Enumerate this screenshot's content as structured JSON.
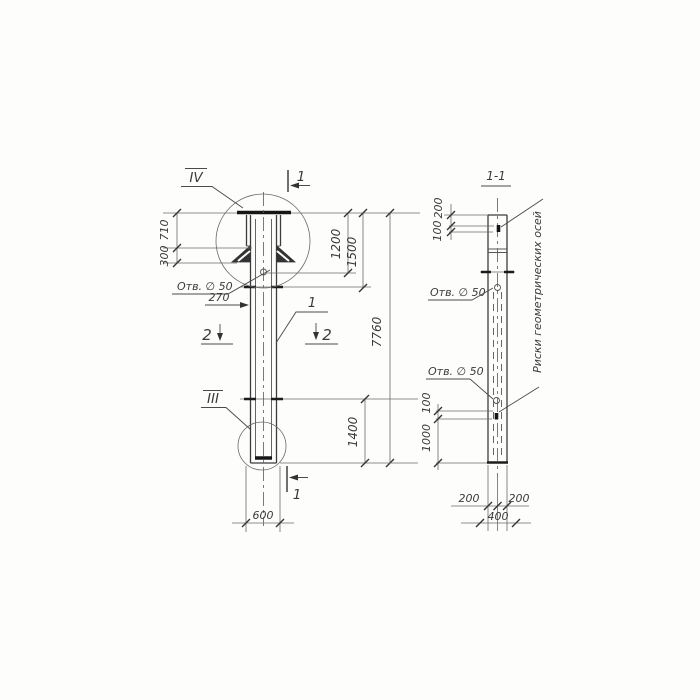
{
  "colors": {
    "ink": "#3a3a3a",
    "paper": "#fdfdfc"
  },
  "elevation": {
    "detail_iv": "IV",
    "detail_iii": "III",
    "section_mark_top": "1",
    "section_mark_bottom": "1",
    "section_mark_left": "2",
    "section_mark_right": "2",
    "part_callout": "1",
    "hole_label": "Отв. ∅ 50",
    "dims": {
      "plate_width": "710",
      "gusset_height": "300",
      "hole_offset": "270",
      "top_to_hole": "1200",
      "top_to_mark": "1500",
      "overall_height": "7760",
      "mark_to_bottom": "1400",
      "column_width": "600"
    }
  },
  "section": {
    "title": "1-1",
    "hole_label_top": "Отв. ∅ 50",
    "hole_label_bottom": "Отв. ∅ 50",
    "axes_note": "Риски геометрических осей",
    "dims": {
      "top_to_mark": "200",
      "mark_length_top": "100",
      "mark_length_bottom": "100",
      "mark_to_bottom": "1000",
      "half_width_left": "200",
      "half_width_right": "200",
      "full_width": "400"
    }
  }
}
